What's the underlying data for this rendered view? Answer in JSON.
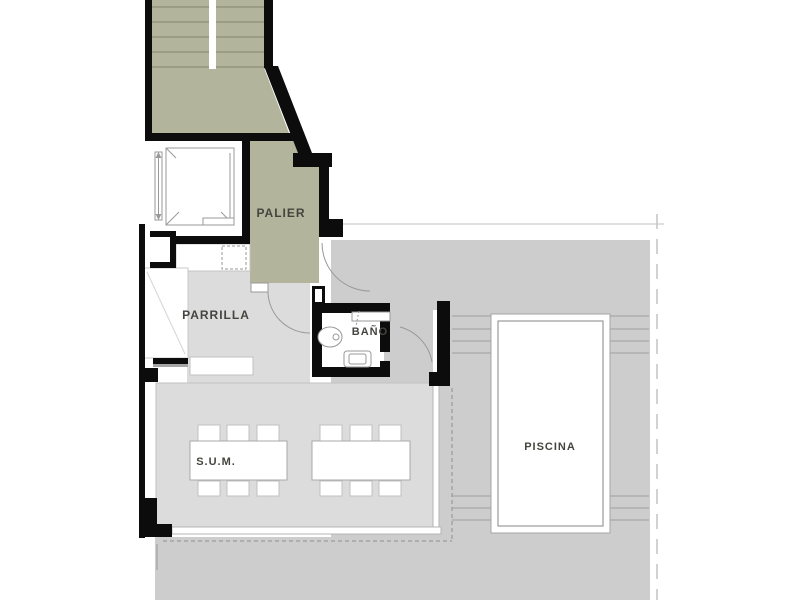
{
  "plan": {
    "type": "architectural-floor-plan",
    "labels": {
      "palier": "PALIER",
      "parrilla": "PARRILLA",
      "bano": "BAÑO",
      "sum": "S.U.M.",
      "piscina": "PISCINA"
    },
    "rooms": [
      {
        "name": "PALIER",
        "kind": "hall"
      },
      {
        "name": "PARRILLA",
        "kind": "grill-room"
      },
      {
        "name": "BAÑO",
        "kind": "bathroom"
      },
      {
        "name": "S.U.M.",
        "kind": "multi-use-room"
      },
      {
        "name": "PISCINA",
        "kind": "pool"
      }
    ],
    "colors": {
      "stair_hall_fill": "#b2b59c",
      "stair_step_line": "#92957d",
      "interior_floor": "#dcdcdc",
      "terrace_floor": "#cdcdcd",
      "wall": "#0c0c0c",
      "thin_line": "#999999",
      "background": "#ffffff",
      "label_text": "#45453f"
    }
  }
}
